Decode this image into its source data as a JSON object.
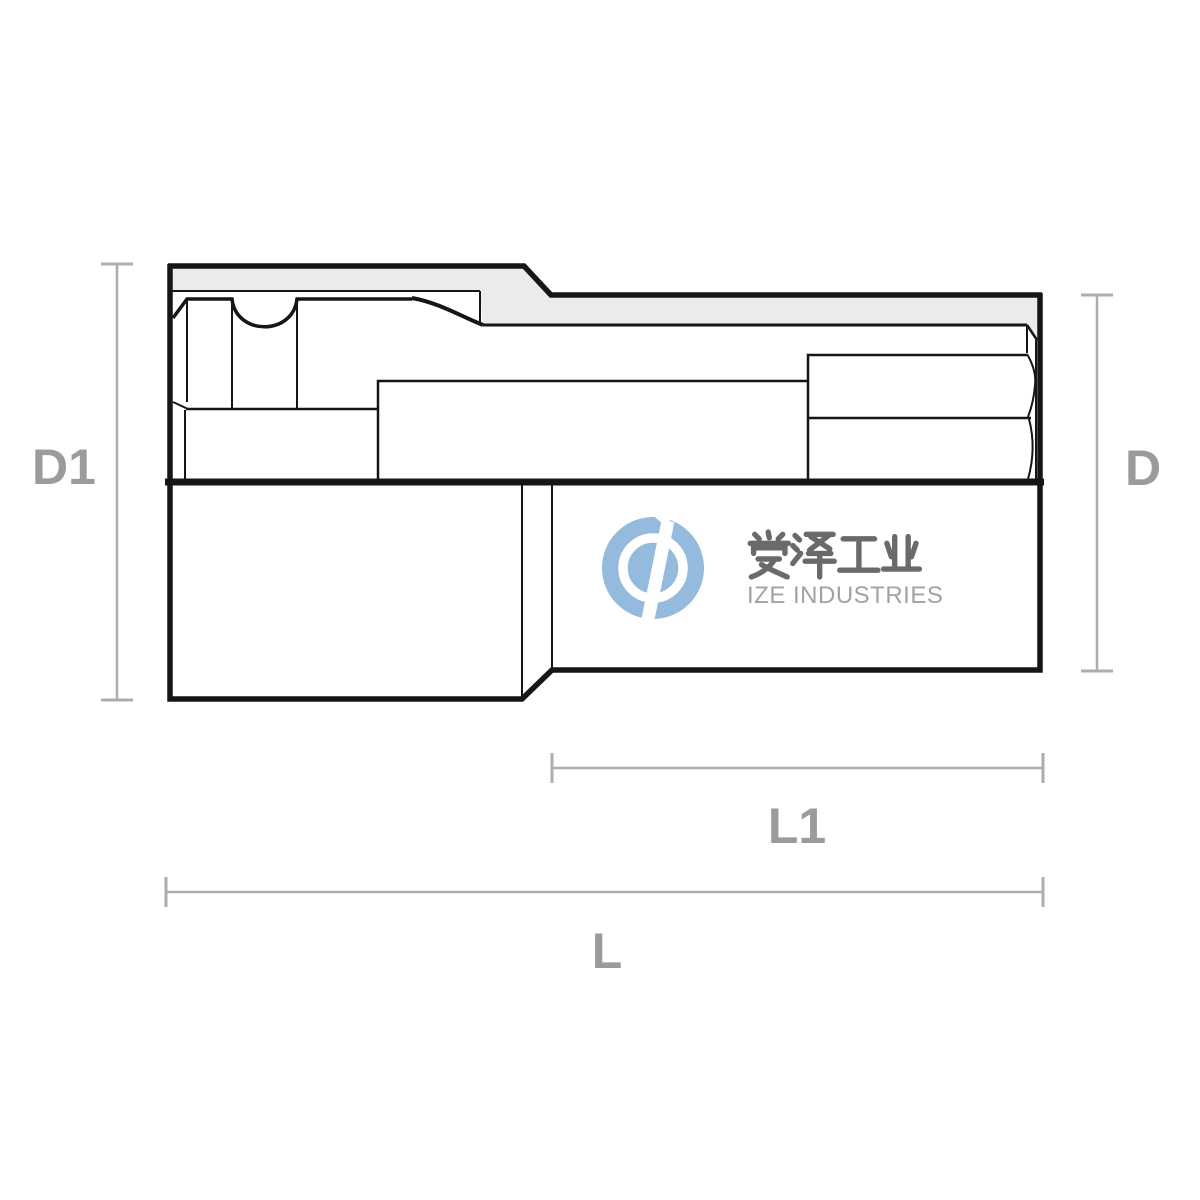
{
  "page": {
    "background": "#ffffff",
    "kind": "technical dimension drawing of a hex bit socket, half section view"
  },
  "drawing": {
    "section_fill": "#ebebeb",
    "line_color": "#161616",
    "dimension_line_color": "#adadad",
    "dimension_label_color": "#9b9b9b",
    "dimensions": [
      {
        "id": "D1",
        "label": "D1",
        "orientation": "vertical",
        "side": "left",
        "measures": "outer diameter of drive end"
      },
      {
        "id": "D",
        "label": "D",
        "orientation": "vertical",
        "side": "right",
        "measures": "outer diameter of bit end"
      },
      {
        "id": "L1",
        "label": "L1",
        "orientation": "horizontal",
        "side": "bottom",
        "measures": "length of bit end section"
      },
      {
        "id": "L",
        "label": "L",
        "orientation": "horizontal",
        "side": "bottom",
        "measures": "overall length"
      }
    ]
  },
  "watermark": {
    "cjk_text": "爱泽工业",
    "latin_text": "IZE INDUSTRIES",
    "logo_color": "#94badd",
    "logo_mark": "circular wrench monogram",
    "cjk_color": "#6a6a6a",
    "latin_color": "#a2a2a2"
  }
}
